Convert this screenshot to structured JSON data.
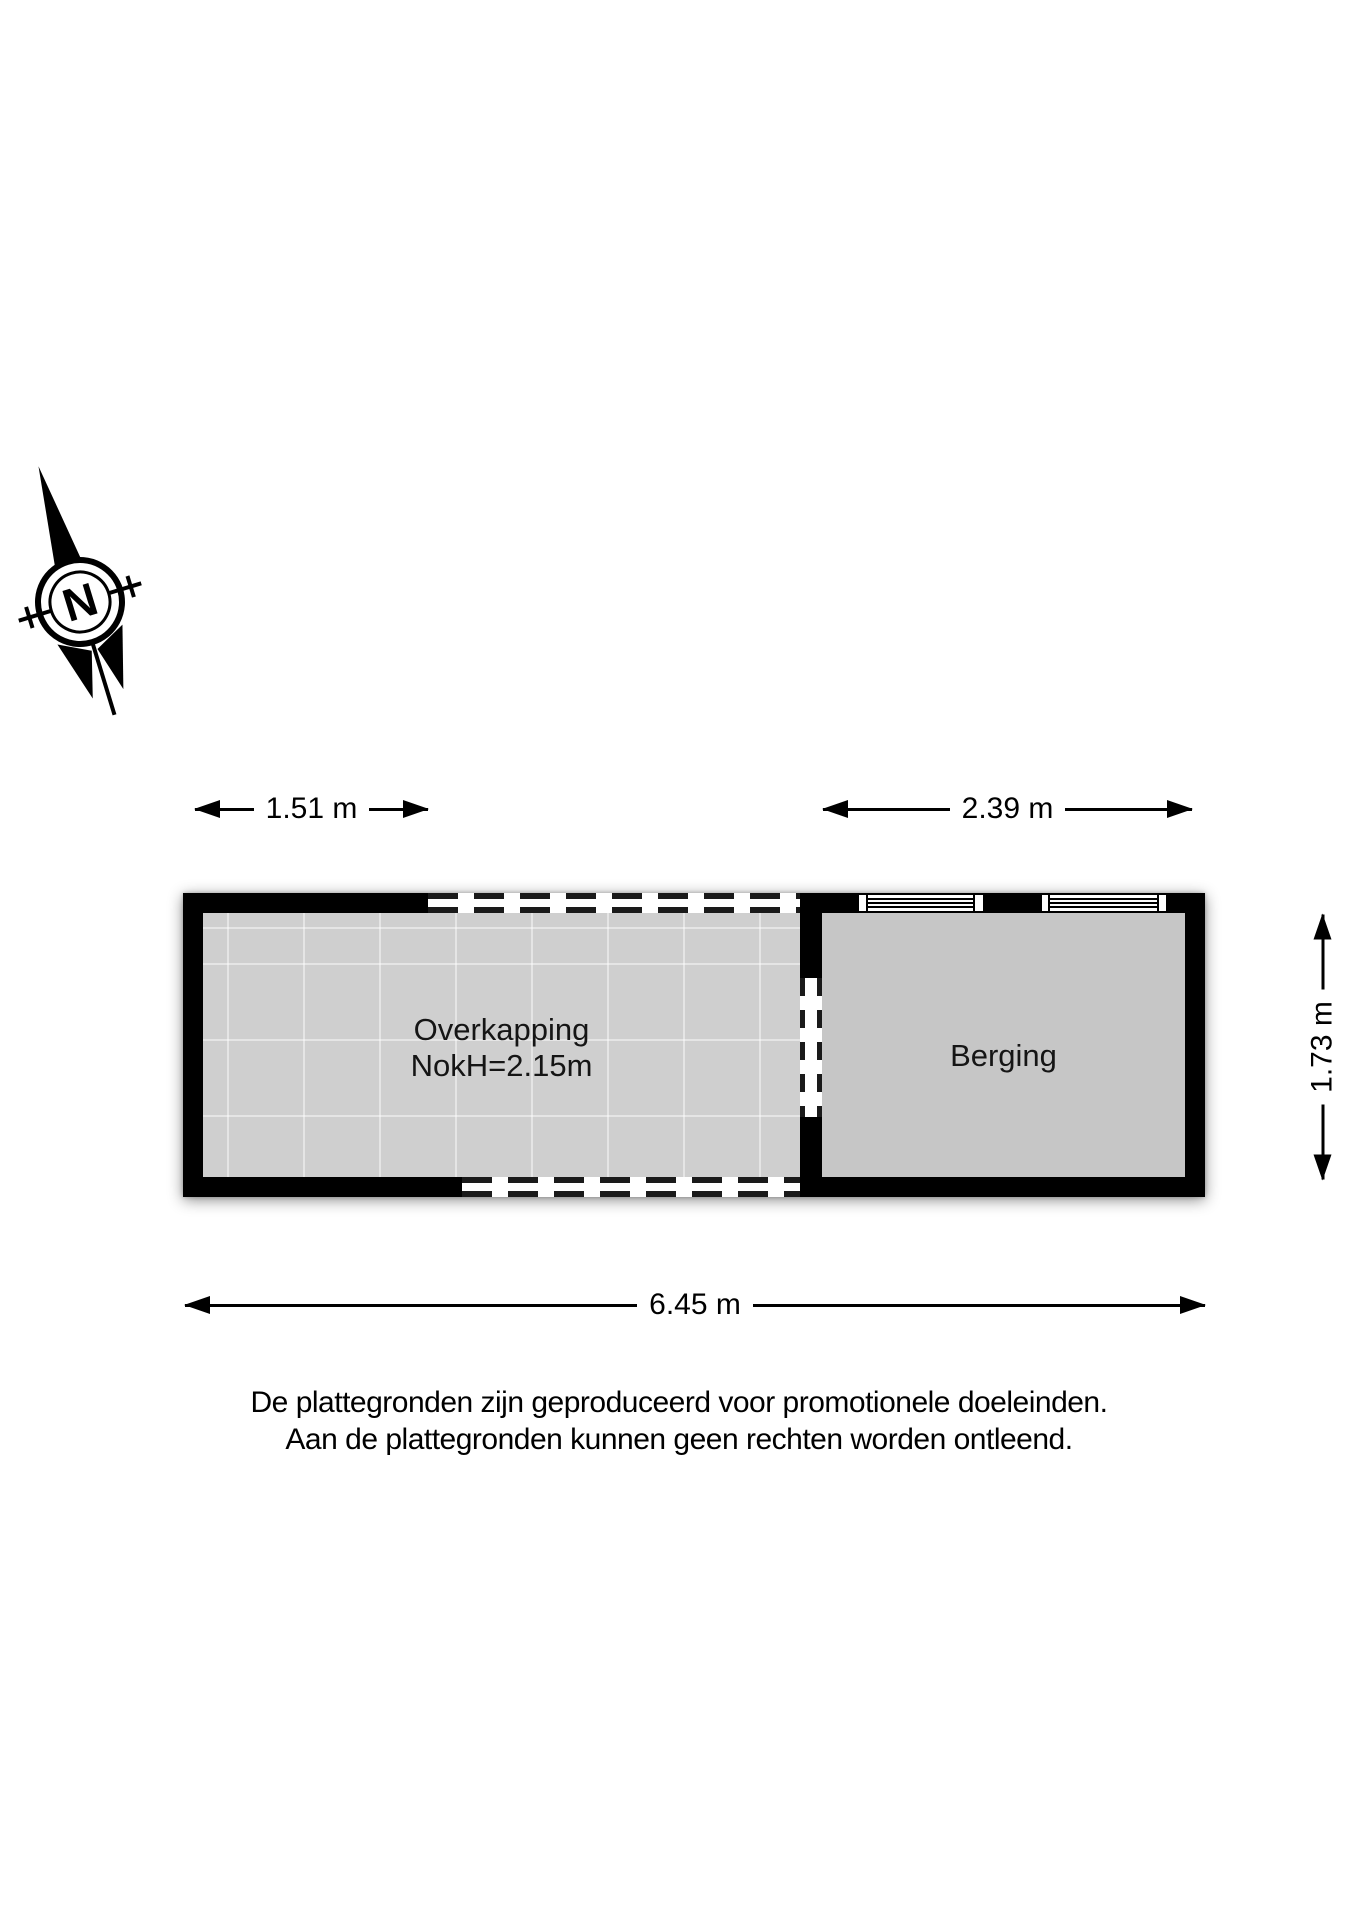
{
  "compass": {
    "label": "N"
  },
  "dimensions": {
    "overkapping_width": "1.51 m",
    "berging_width": "2.39 m",
    "berging_depth": "1.73 m",
    "total_width": "6.45 m"
  },
  "rooms": {
    "overkapping": {
      "name": "Overkapping",
      "ridge_height": "NokH=2.15m"
    },
    "berging": {
      "name": "Berging"
    }
  },
  "disclaimer": {
    "line1": "De plattegronden zijn geproduceerd voor promotionele doeleinden.",
    "line2": "Aan de plattegronden kunnen geen rechten worden ontleend."
  },
  "colors": {
    "wall": "#000000",
    "overkapping_floor": "#cfcfcf",
    "berging_floor": "#c6c6c6",
    "text": "#111111"
  }
}
